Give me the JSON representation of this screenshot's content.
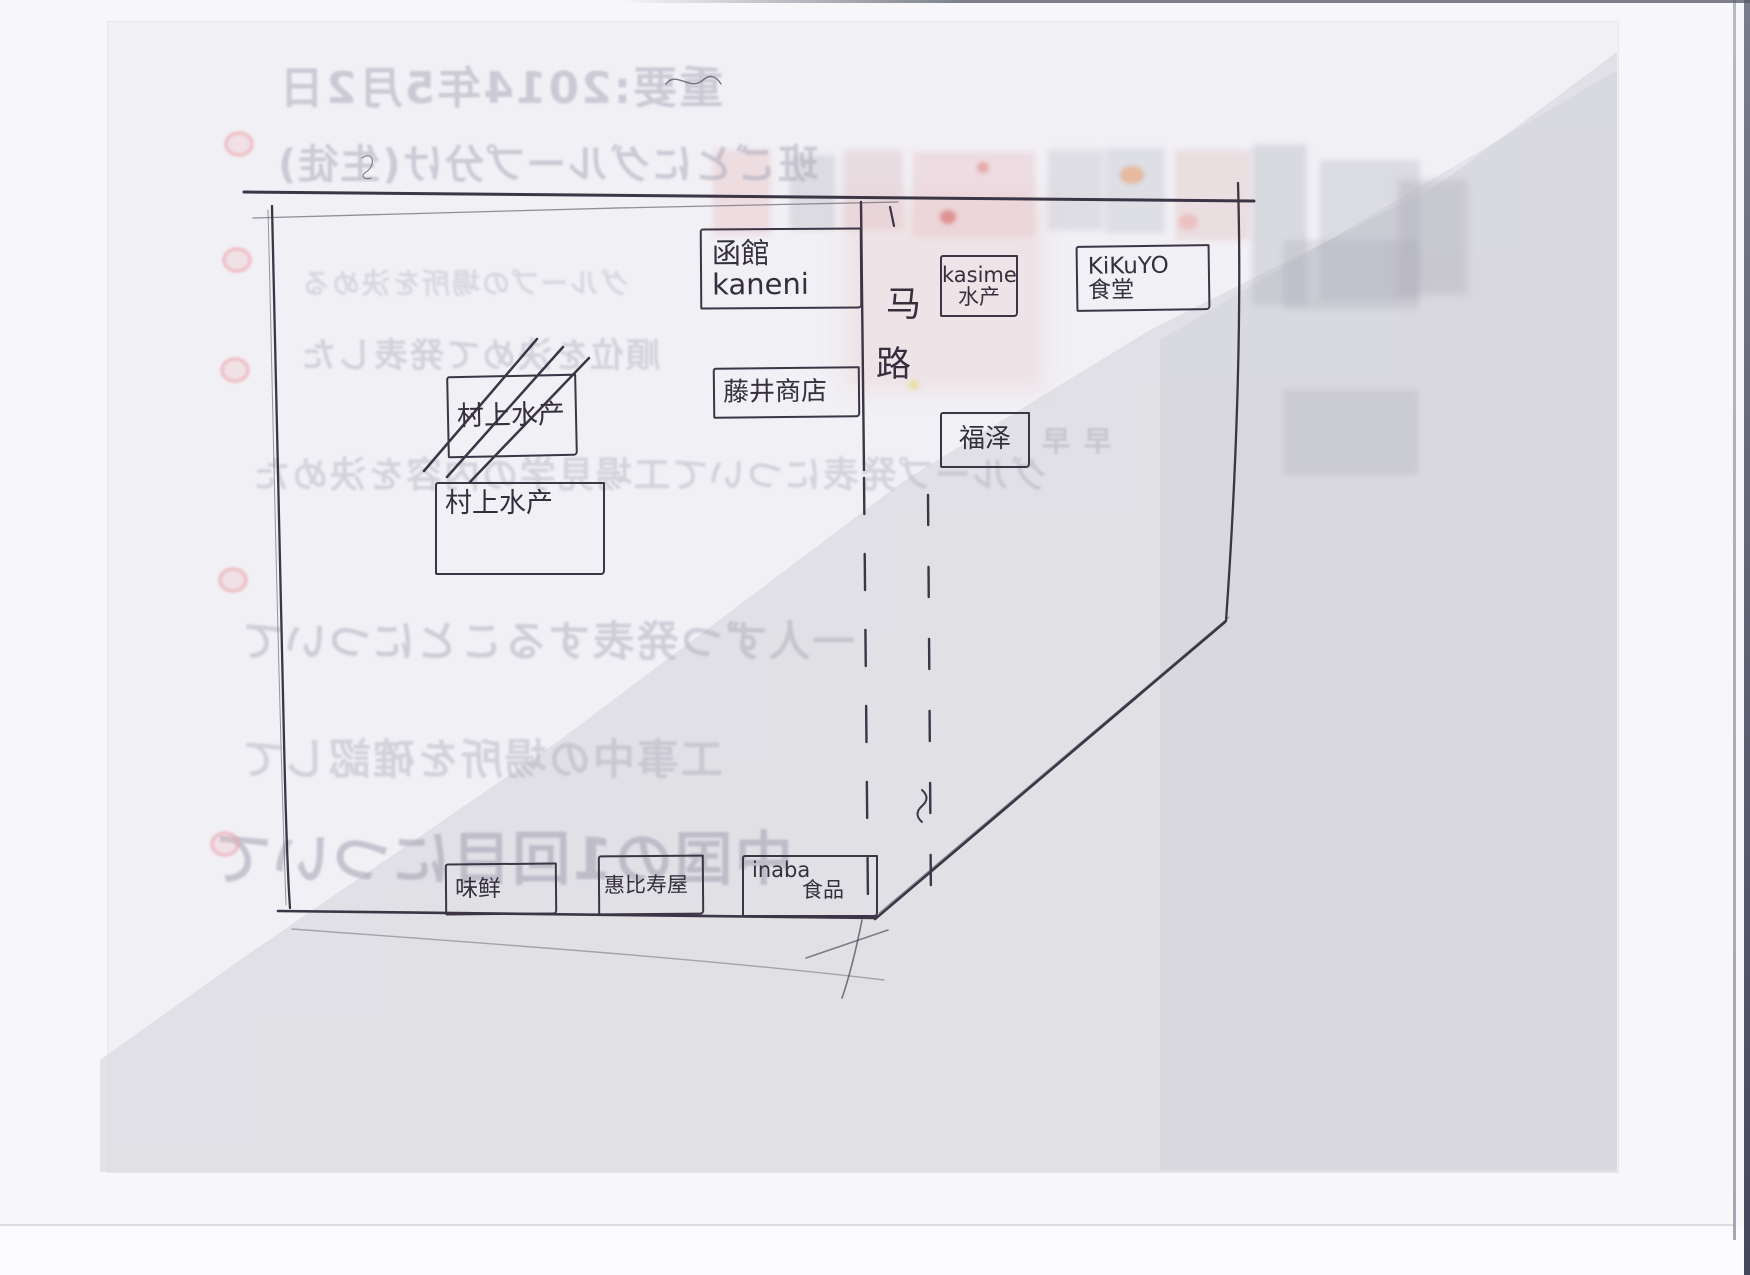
{
  "map": {
    "road_label": "马路",
    "road_label_chars": [
      "马",
      "路"
    ],
    "buildings": [
      {
        "id": "hakodate-kaneni",
        "lines": [
          "函館kaneni"
        ],
        "crossed_out": false
      },
      {
        "id": "fujii-shoten",
        "lines": [
          "藤井商店"
        ],
        "crossed_out": false
      },
      {
        "id": "murakami-suisan-crossed",
        "lines": [
          "村上水产"
        ],
        "crossed_out": true
      },
      {
        "id": "murakami-suisan",
        "lines": [
          "村上水产"
        ],
        "crossed_out": false
      },
      {
        "id": "kasime-suisan",
        "lines": [
          "kasime",
          "水产"
        ],
        "crossed_out": false
      },
      {
        "id": "kikuyo-shokudo",
        "lines": [
          "KiKuYO",
          "食堂"
        ],
        "crossed_out": false
      },
      {
        "id": "fukuzawa",
        "lines": [
          "福泽"
        ],
        "crossed_out": false
      },
      {
        "id": "weixian",
        "lines": [
          "味鲜"
        ],
        "crossed_out": false
      },
      {
        "id": "ebisuya",
        "lines": [
          "惠比寿屋"
        ],
        "crossed_out": false
      },
      {
        "id": "inaba-shokuhin",
        "lines": [
          "inaba",
          "食品"
        ],
        "crossed_out": false
      }
    ]
  },
  "ghost_text": {
    "lines": [
      {
        "text": "重要:2014年5月2日"
      },
      {
        "text": "班ごとにグループ分け(生徒)"
      },
      {
        "text": "グループの場所を決める"
      },
      {
        "text": "順位を決めて発表した"
      },
      {
        "text": "グループ発表について工場見学の内容を決めた"
      },
      {
        "text": "一人ずつ発表することについて"
      },
      {
        "text": "工事中の場所を確認して"
      },
      {
        "text": "中国の1回目について"
      },
      {
        "text": "早 早"
      }
    ],
    "bullet_count": 5
  },
  "colors": {
    "pen": "#3c3545",
    "paper": "#f1f0f5",
    "scan_shade": "#d4d3d9",
    "ghost_text": "#a6a5b5",
    "bullet_pink": "#eba3ad"
  }
}
